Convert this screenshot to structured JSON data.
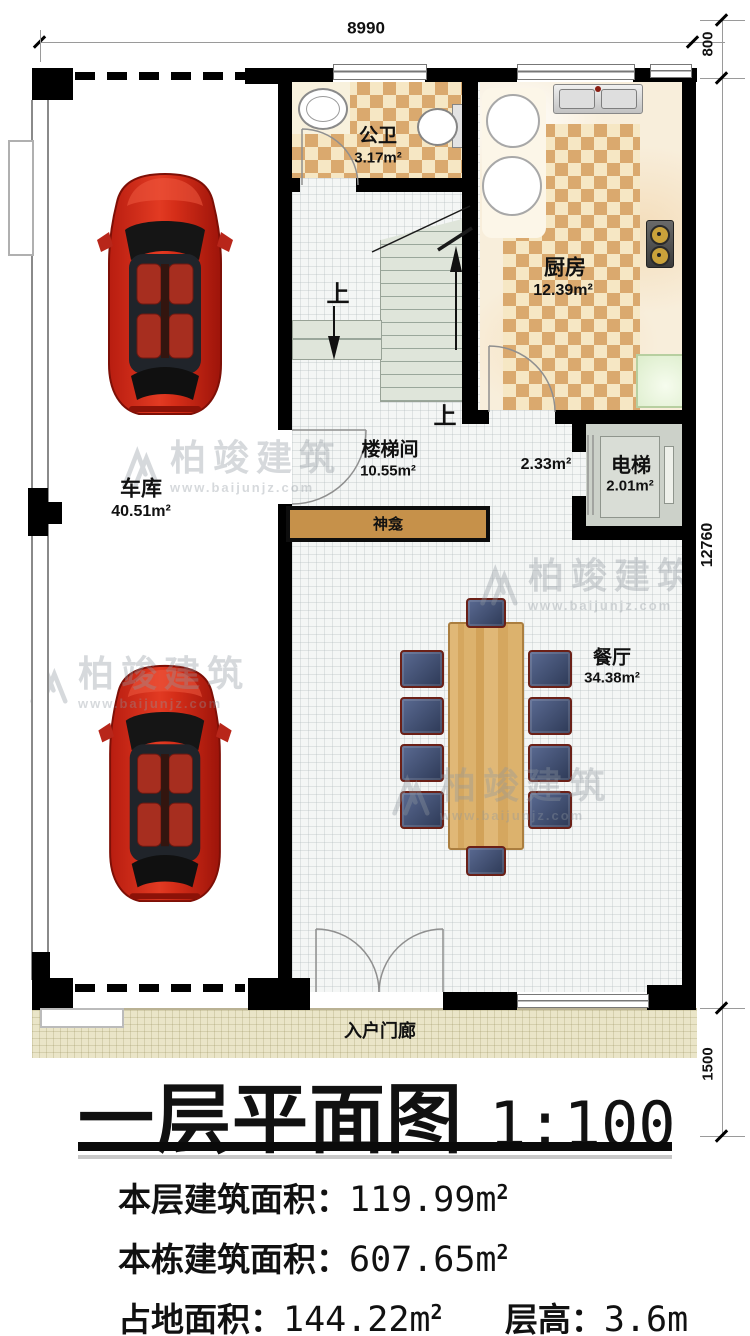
{
  "plan": {
    "dims": {
      "top": "8990",
      "right_top": "800",
      "right_mid": "12760",
      "right_bottom": "1500"
    },
    "rooms": {
      "garage": {
        "name": "车库",
        "area": "40.51m²"
      },
      "bathroom": {
        "name": "公卫",
        "area": "3.17m²"
      },
      "kitchen": {
        "name": "厨房",
        "area": "12.39m²"
      },
      "stairwell": {
        "name": "楼梯间",
        "area": "10.55m²"
      },
      "hallway": {
        "area": "2.33m²"
      },
      "elevator": {
        "name": "电梯",
        "area": "2.01m²"
      },
      "dining": {
        "name": "餐厅",
        "area": "34.38m²"
      },
      "shrine": {
        "name": "神龛"
      },
      "porch": {
        "name": "入户门廊"
      }
    },
    "stairs": {
      "up1": "上",
      "up2": "上"
    }
  },
  "titleblock": {
    "title": "一层平面图",
    "scale": "1:100"
  },
  "stats": {
    "line1": {
      "label": "本层建筑面积：",
      "value": "119.99m",
      "sup": "2"
    },
    "line2": {
      "label": "本栋建筑面积：",
      "value": "607.65m",
      "sup": "2"
    },
    "line3": {
      "label": "占地面积：",
      "value": "144.22m",
      "sup": "2"
    },
    "line3b": {
      "label": "层高：",
      "value": "3.6m"
    }
  },
  "watermark": {
    "brand": "柏竣建筑",
    "url": "www.baijunjz.com"
  },
  "colors": {
    "wall": "#000000",
    "checker_dark": "#daa96e",
    "checker_light": "#f6e7c4",
    "shrine_fill": "#c6914a",
    "table_wood": "#d9af6c",
    "car_red": "#c5271a",
    "stair_floor": "#dfe5da",
    "porch_floor": "#eae5c8"
  }
}
